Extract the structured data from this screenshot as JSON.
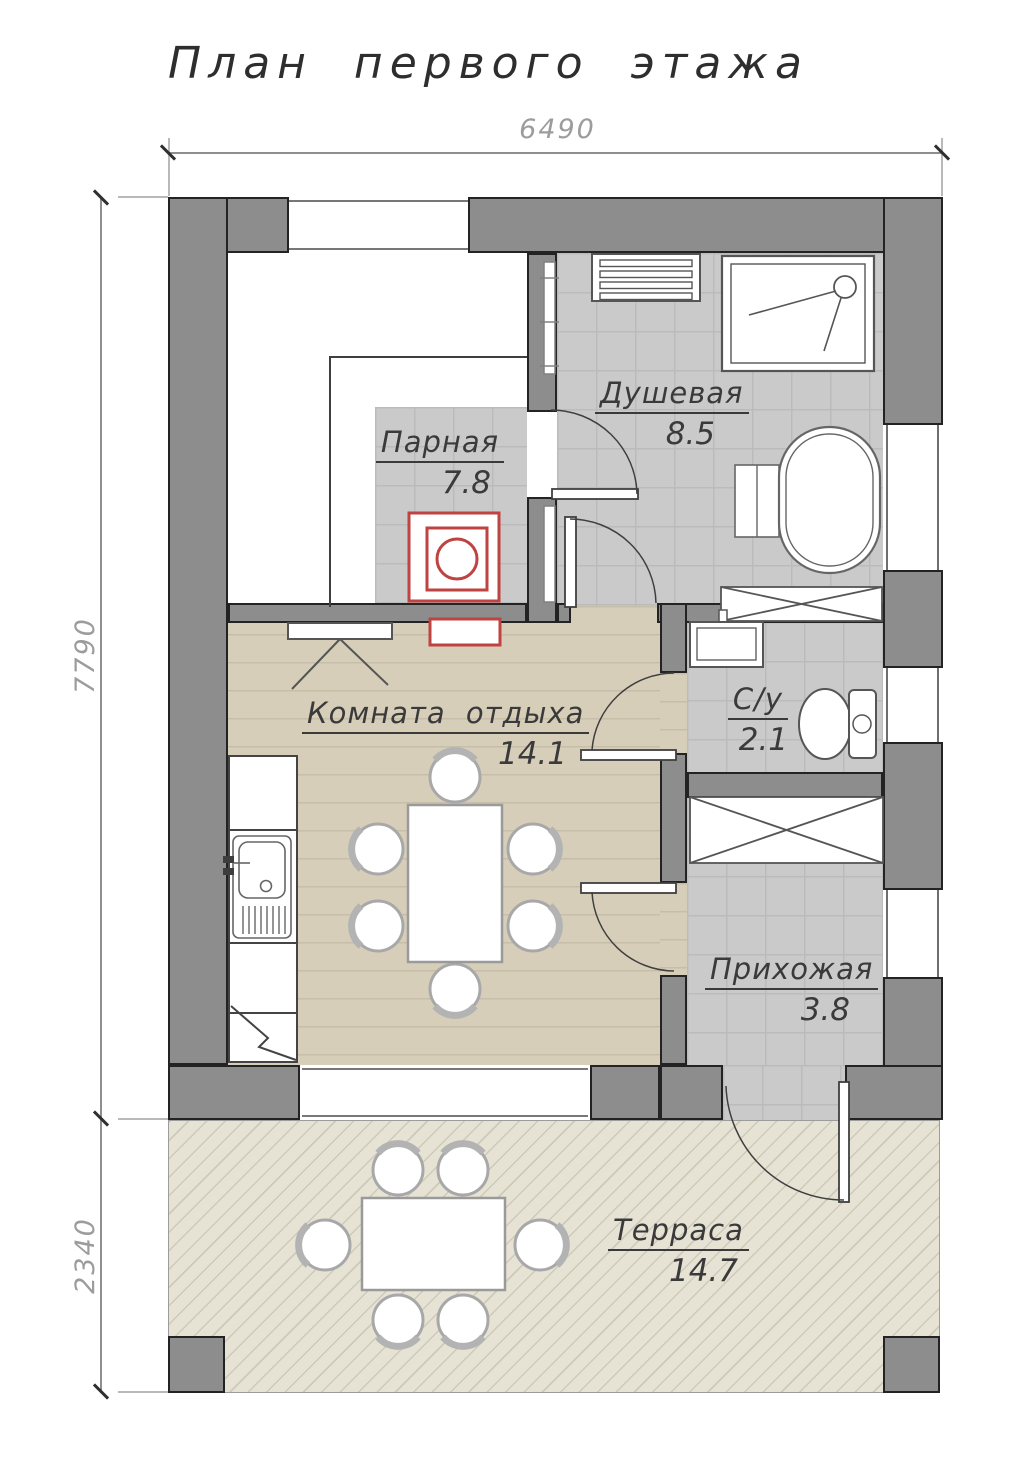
{
  "title": "План первого этажа",
  "dimensions": {
    "top": "6490",
    "left": "7790",
    "terrace": "2340"
  },
  "rooms": [
    {
      "name": "Парная",
      "area": "7.8"
    },
    {
      "name": "Душевая",
      "area": "8.5"
    },
    {
      "name": "Комната отдыха",
      "area": "14.1"
    },
    {
      "name": "С/у",
      "area": "2.1"
    },
    {
      "name": "Прихожая",
      "area": "3.8"
    },
    {
      "name": "Терраса",
      "area": "14.7"
    }
  ],
  "colors": {
    "wall": "#8d8d8d",
    "outline": "#232323",
    "tile_floor": "#cbcaca",
    "wood_floor": "#d7ceba",
    "terrace_floor": "#e6e3d4",
    "stove_accent": "#bf4341",
    "dimension_text": "#9c9c9c",
    "label_text": "#3a3a3a"
  }
}
